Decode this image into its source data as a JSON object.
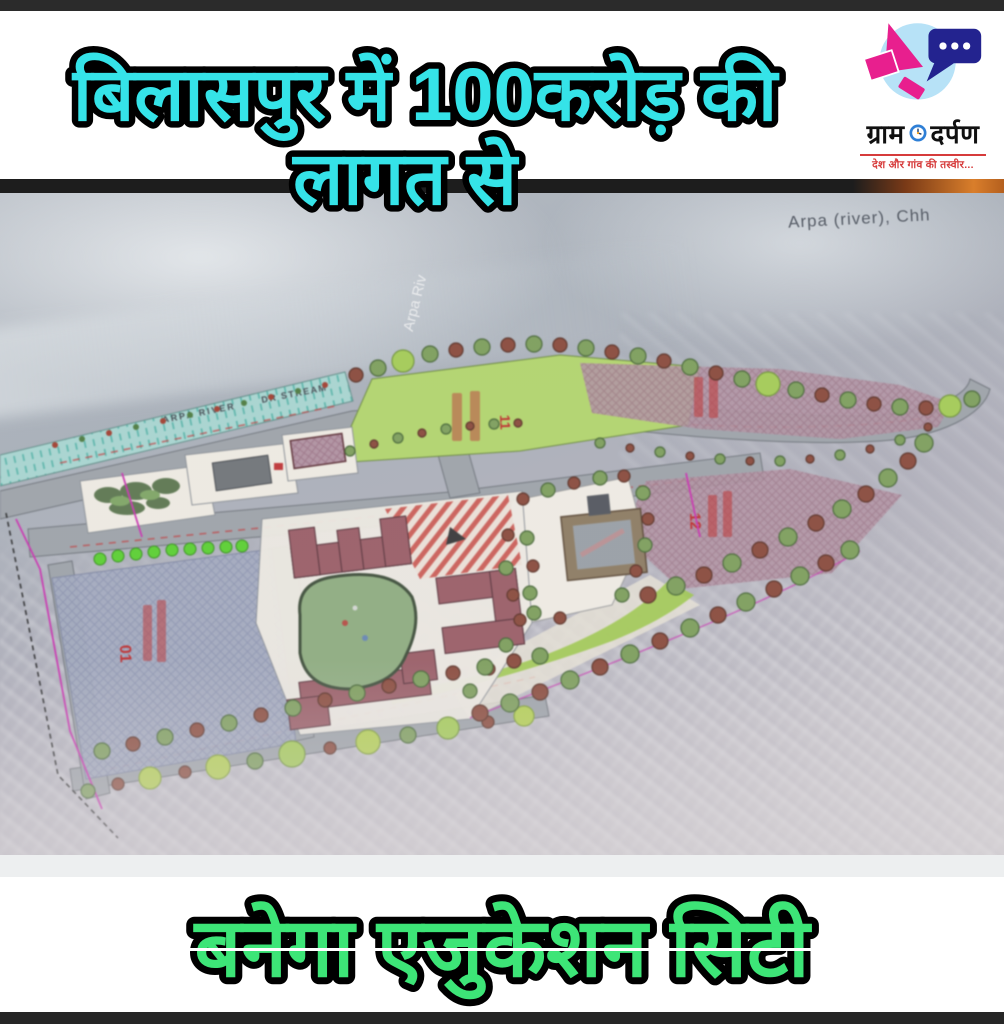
{
  "header": {
    "headline_line1": "बिलासपुर में 100करोड़ की",
    "headline_line2": "लागत से"
  },
  "logo": {
    "brand_left": "ग्राम",
    "brand_right": "दर्पण",
    "tagline": "देश और गांव की तस्वीर..."
  },
  "map": {
    "river_label_top": "Arpa (river), Chh",
    "river_label_vertical": "Arpa Riv",
    "river_band_label": "ARPA RIVER",
    "stream_label": "DR STREAM",
    "plots": {
      "p01": "01",
      "p11": "11",
      "p12": "12"
    }
  },
  "footer": {
    "headline": "बनेगा एजुकेशन सिटी"
  },
  "colors": {
    "headline_cyan": "#35E3E8",
    "headline_green": "#3DE577",
    "logo_pink": "#E81F8E",
    "logo_navy": "#23238F",
    "logo_circle_blue": "#B7E2F7",
    "tagline_red": "#D63B3B",
    "plot_label_red": "#C23030"
  }
}
